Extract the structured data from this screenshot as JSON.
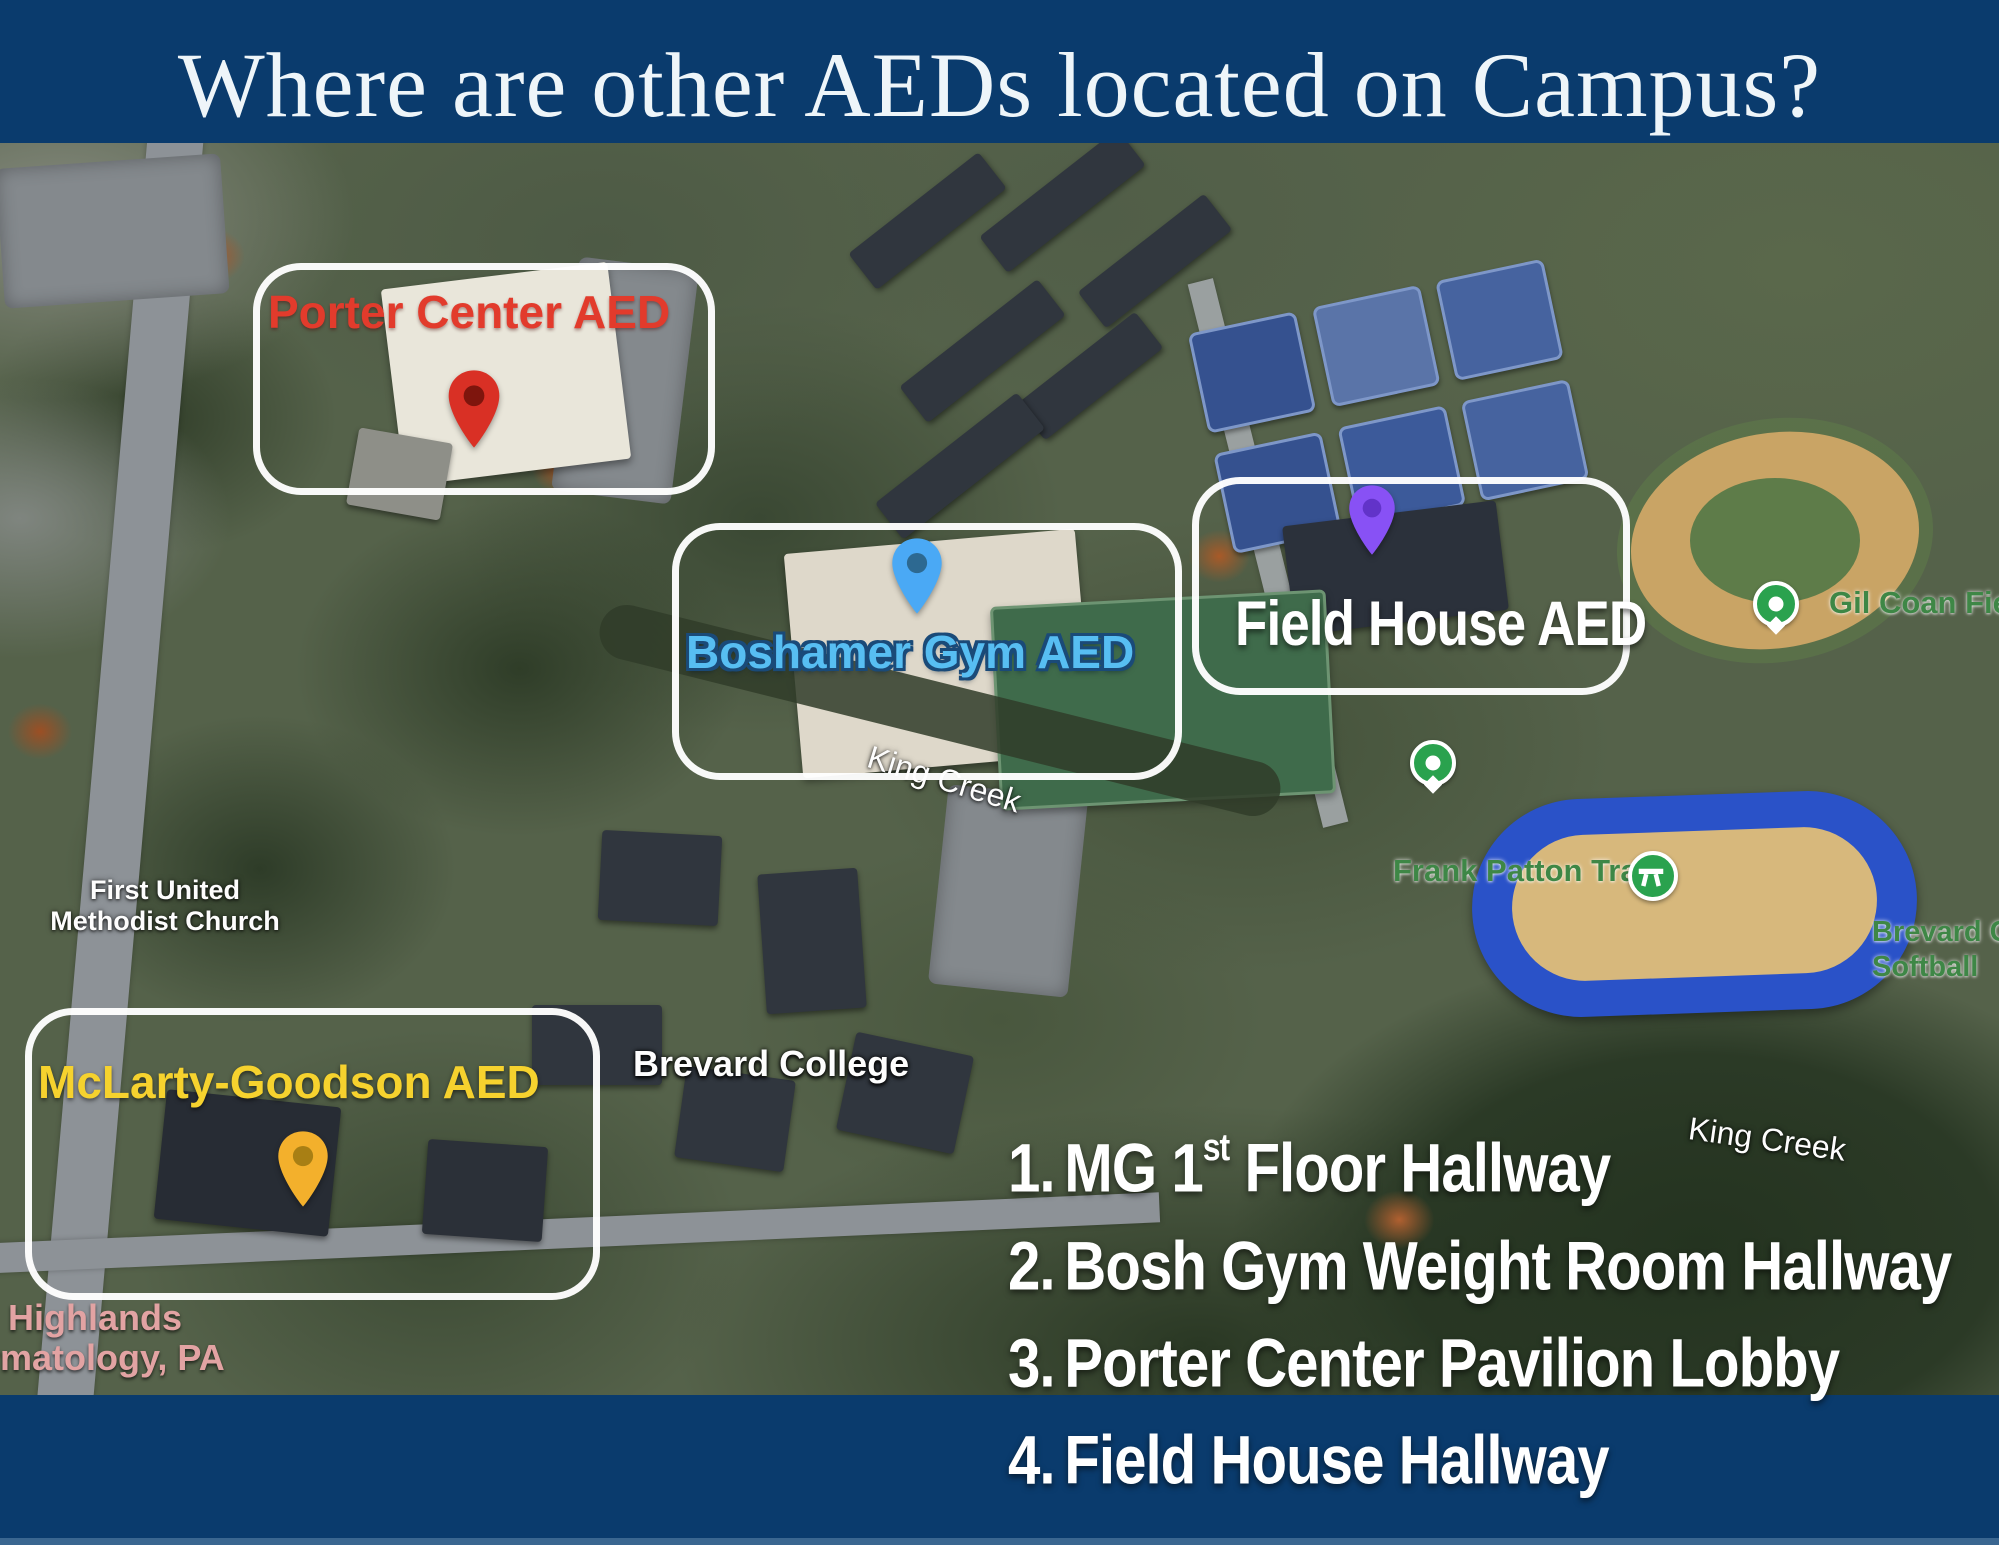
{
  "title": "Where are other AEDs located on Campus?",
  "colors": {
    "background_navy": "#0a3b6d",
    "porter_label": "#e23b2c",
    "porter_pin": "#d93025",
    "boshamer_label": "#57bef2",
    "boshamer_pin": "#4aa9f5",
    "fieldhouse_label": "#ffffff",
    "fieldhouse_pin": "#8851f5",
    "mclarty_label": "#f6d22e",
    "mclarty_pin": "#f3b02c",
    "map_green_marker": "#2aa24e"
  },
  "aed_zones": [
    {
      "id": "porter",
      "label": "Porter Center AED"
    },
    {
      "id": "boshamer",
      "label": "Boshamer Gym AED"
    },
    {
      "id": "fieldhouse",
      "label": "Field House AED"
    },
    {
      "id": "mclarty",
      "label": "McLarty-Goodson AED"
    }
  ],
  "map_labels": {
    "church_line1": "First United",
    "church_line2": "Methodist Church",
    "brevard_college": "Brevard College",
    "king_creek_center": "King Creek",
    "king_creek_right": "King Creek",
    "gil_coan": "Gil Coan Fiel",
    "frank_patton": "Frank Patton Track",
    "softball_line1": "Brevard C",
    "softball_line2": "Softball",
    "highlands_line1": "Highlands",
    "highlands_line2": "rmatology, PA"
  },
  "aed_list": {
    "items": [
      {
        "num": "1.",
        "pre": "MG 1",
        "sup": "st",
        "post": " Floor Hallway"
      },
      {
        "num": "2.",
        "label": "Bosh Gym Weight Room Hallway"
      },
      {
        "num": "3.",
        "label": "Porter Center Pavilion Lobby"
      },
      {
        "num": "4.",
        "label": "Field House Hallway"
      }
    ]
  }
}
